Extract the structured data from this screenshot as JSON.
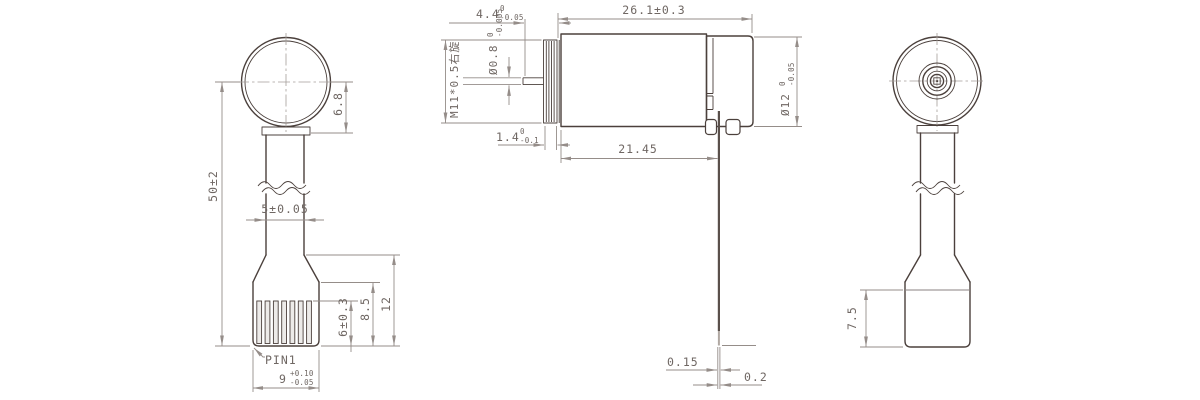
{
  "drawing": {
    "front_view": {
      "overall_height": "50±2",
      "head_offset": "6.8",
      "stem_width": "5±0.05",
      "mount_height": "12",
      "base_height": "8.5",
      "pin_exposed": "6±0.3",
      "pin1_label": "PIN1",
      "base_width": "9",
      "base_width_upper": "+0.10",
      "base_width_lower": "-0.05"
    },
    "side_view": {
      "shaft_len": "4.4",
      "shaft_len_upper": "0",
      "shaft_len_lower": "-0.05",
      "shaft_dia": "Ø0.8",
      "shaft_dia_upper": "0",
      "shaft_dia_lower": "-0.005",
      "thread_spec": "M11*0.5右旋",
      "body_len": "26.1±0.3",
      "thread_len": "1.4",
      "thread_len_upper": "0",
      "thread_len_lower": "-0.1",
      "pin_offset": "21.45",
      "body_dia": "Ø12",
      "body_dia_upper": "0",
      "body_dia_lower": "-0.05",
      "pin_thickness_a": "0.15",
      "pin_thickness_b": "0.2"
    },
    "rear_view": {
      "base_block_height": "7.5"
    },
    "colors": {
      "object_line": "#4b403c",
      "dim_line": "#958d89",
      "background": "#ffffff"
    }
  }
}
